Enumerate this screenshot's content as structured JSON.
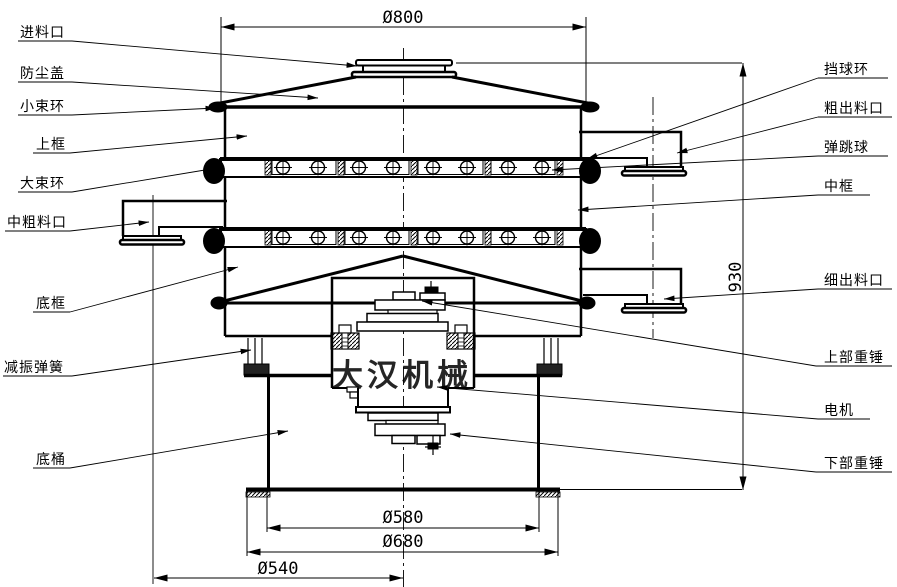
{
  "diagram": {
    "watermark": "大汉机械",
    "labels": {
      "left": [
        "进料口",
        "防尘盖",
        "小束环",
        "上框",
        "大束环",
        "中粗料口",
        "底框",
        "减振弹簧",
        "底桶"
      ],
      "right": [
        "挡球环",
        "粗出料口",
        "弹跳球",
        "中框",
        "细出料口",
        "上部重锤",
        "电机",
        "下部重锤"
      ]
    },
    "dimensions": {
      "top_diameter": "Ø800",
      "height": "930",
      "base_inner_diameter": "Ø580",
      "base_flange_diameter": "Ø680",
      "outlet_center_offset": "Ø540"
    },
    "colors": {
      "line": "#000000",
      "background": "#ffffff",
      "watermark": "#bdbdbd"
    }
  }
}
